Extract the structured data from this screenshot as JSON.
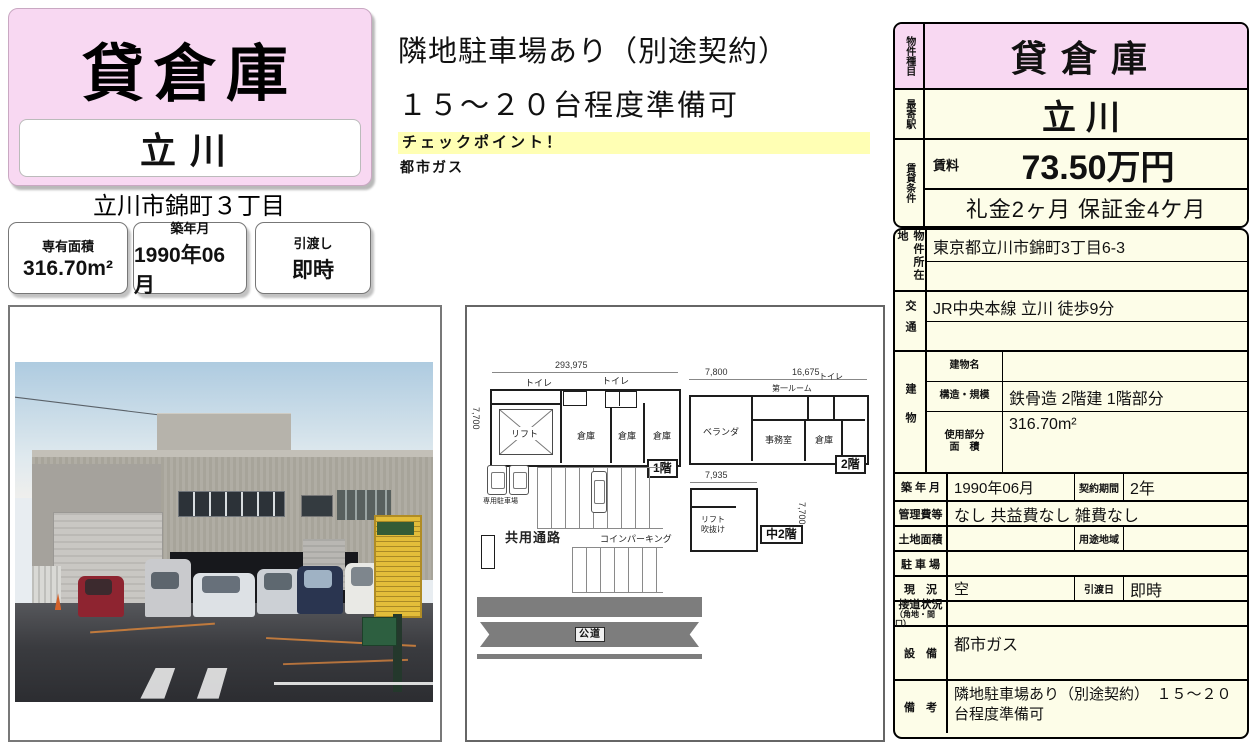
{
  "colors": {
    "banner_pink": "#f8d8f2",
    "cell_cream": "#fdfde8",
    "highlight_yellow": "#ffffb4",
    "road_gray": "#7d7d7d",
    "sign_yellow": "#e3bd3a"
  },
  "header": {
    "property_type": "貸倉庫",
    "property_name": "立川",
    "address_line": "立川市錦町３丁目"
  },
  "summary": [
    {
      "label": "専有面積",
      "value": "316.70m²"
    },
    {
      "label": "築年月",
      "value": "1990年06月"
    },
    {
      "label": "引渡し",
      "value": "即時"
    }
  ],
  "notes": {
    "line1": "隣地駐車場あり（別途契約）",
    "line2": "１５～２０台程度準備可",
    "checkpoint_label": "チェックポイント！",
    "checkpoint_item": "都市ガス"
  },
  "plan": {
    "f1": {
      "dim_w": "293,975",
      "dim_h": "7,700",
      "toilet1": "トイレ",
      "toilet2": "トイレ",
      "lift": "リフト",
      "s1": "倉庫",
      "s2": "倉庫",
      "s3": "倉庫",
      "badge": "1階"
    },
    "f2": {
      "dim_w1": "7,800",
      "dim_w2": "16,675",
      "toilet": "トイレ",
      "first_room": "第一ルーム",
      "veranda": "ベランダ",
      "office": "事務室",
      "storage": "倉庫",
      "badge": "2階"
    },
    "mezz": {
      "dim_w": "7,935",
      "dim_h": "7,700",
      "line1": "リフト",
      "line2": "吹抜け",
      "badge": "中2階"
    },
    "ground": {
      "private_parking": "専用駐車場",
      "shared_passage": "共用通路",
      "coin_parking": "コインパーキング",
      "road": "公道"
    }
  },
  "table_top": {
    "type_label": "物件種目",
    "type": "貸倉庫",
    "station_label": "最寄駅",
    "station": "立川",
    "terms_label": "賃貸条件",
    "rent_label": "賃料",
    "rent": "73.50万円",
    "fees": "礼金2ヶ月 保証金4ケ月"
  },
  "table_main": {
    "location_label": "物件所在地",
    "location": "東京都立川市錦町3丁目6-3",
    "access_label": "交通",
    "access": "JR中央本線 立川 徒歩9分",
    "building_label": "建物",
    "building_name_label": "建物名",
    "building_name": "",
    "structure_label": "構造・規模",
    "structure": "鉄骨造 2階建 1階部分",
    "area_label1": "使用部分",
    "area_label2": "面　積",
    "area": "316.70m²",
    "built_label": "築 年 月",
    "built": "1990年06月",
    "contract_label": "契約期間",
    "contract": "2年",
    "mgmt_label": "管理費等",
    "mgmt": "なし 共益費なし 雑費なし",
    "land_label": "土地面積",
    "land": "",
    "zoning_label": "用途地域",
    "zoning": "",
    "parking_label": "駐 車 場",
    "parking": "",
    "status_label": "現　況",
    "status": "空",
    "handover_label": "引渡日",
    "handover": "即時",
    "roadside_label": "接道状況",
    "roadside_sub": "（角地・間口）",
    "roadside": "",
    "equip_label": "設　備",
    "equip": "都市ガス",
    "remarks_label": "備　考",
    "remarks": "隣地駐車場あり（別途契約）　１５～２０台程度準備可"
  }
}
